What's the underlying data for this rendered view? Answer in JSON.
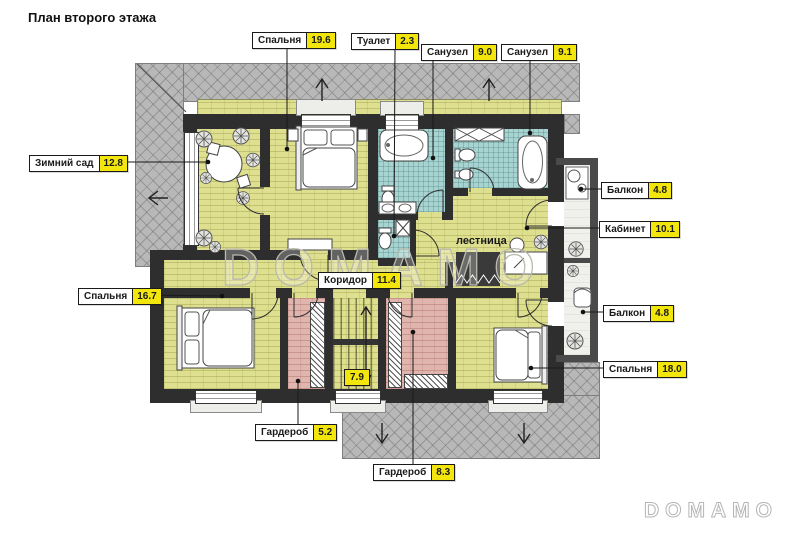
{
  "title": "План второго этажа",
  "watermark": {
    "center": "DOMAMO",
    "corner": "DOMAMO"
  },
  "colors": {
    "label_value_bg": "#f2e60d",
    "floor_yellow": "#dfdf90",
    "tile_teal": "#a7d3d0",
    "wardrobe_pink": "#e0b5ae",
    "roof_gray": "#b8b8b8",
    "wall": "#2e2e2e",
    "balcony_floor": "#f0f0ec"
  },
  "rooms": [
    {
      "label": "Зимний сад",
      "area": "12.8"
    },
    {
      "label": "Спальня",
      "area": "19.6"
    },
    {
      "label": "Туалет",
      "area": "2.3"
    },
    {
      "label": "Санузел",
      "area": "9.0"
    },
    {
      "label": "Санузел",
      "area": "9.1"
    },
    {
      "label": "Балкон",
      "area": "4.8"
    },
    {
      "label": "Кабинет",
      "area": "10.1"
    },
    {
      "label": "Спальня",
      "area": "16.7"
    },
    {
      "label": "Коридор",
      "area": "11.4"
    },
    {
      "label": "Балкон",
      "area": "4.8"
    },
    {
      "label": "Спальня",
      "area": "18.0"
    },
    {
      "label": "Гардероб",
      "area": "5.2"
    },
    {
      "label": "Гардероб",
      "area": "8.3"
    },
    {
      "area": "7.9"
    },
    {
      "label": "лестница"
    }
  ]
}
